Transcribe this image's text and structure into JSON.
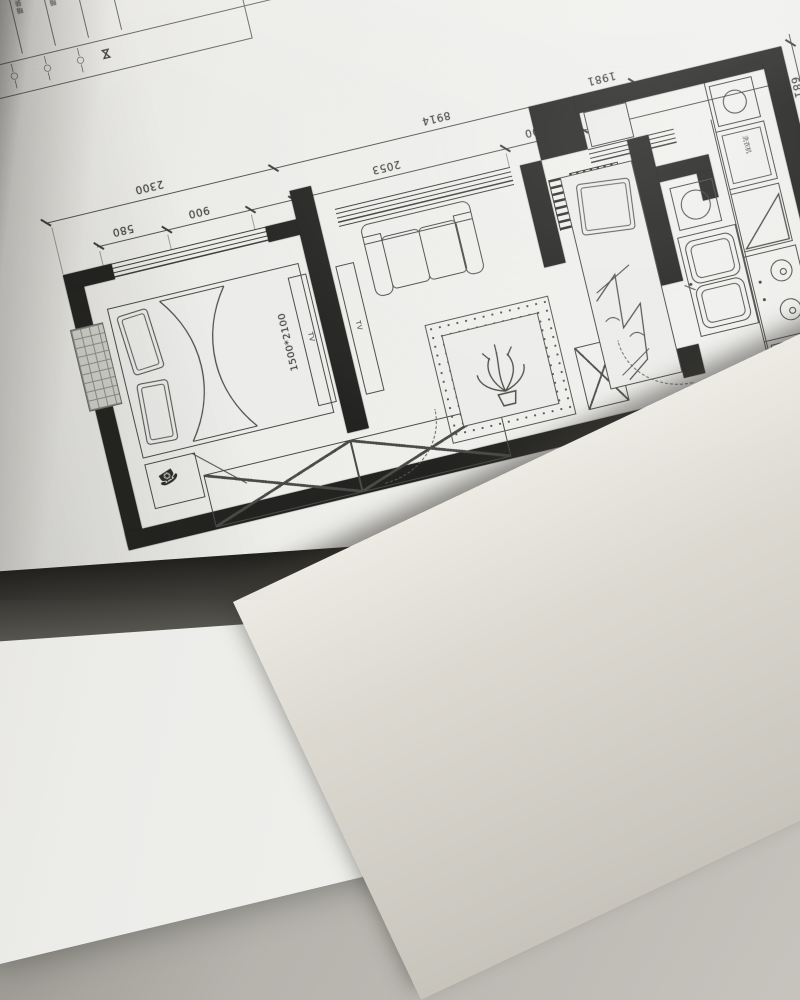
{
  "legend": {
    "rows": [
      {
        "label": "吸顶灯",
        "symbol": "—○—"
      },
      {
        "label": "防水吸顶灯",
        "symbol": "—○—"
      },
      {
        "label": "单头射灯",
        "symbol": "—○—"
      },
      {
        "label": "暗装单极开关",
        "symbol": "—○—"
      },
      {
        "label": "暗装五孔插座",
        "symbol": "—○—"
      },
      {
        "label": "配电箱",
        "symbol": "⋈"
      }
    ]
  },
  "dimensions": {
    "outer": [
      "2300",
      "8914",
      "1981"
    ],
    "inner": [
      "580",
      "900",
      "2053",
      "600"
    ],
    "right": "681"
  },
  "furniture": {
    "bed_label": "1500*2100",
    "tv_label": "TV",
    "washer_label": "洗衣机"
  }
}
